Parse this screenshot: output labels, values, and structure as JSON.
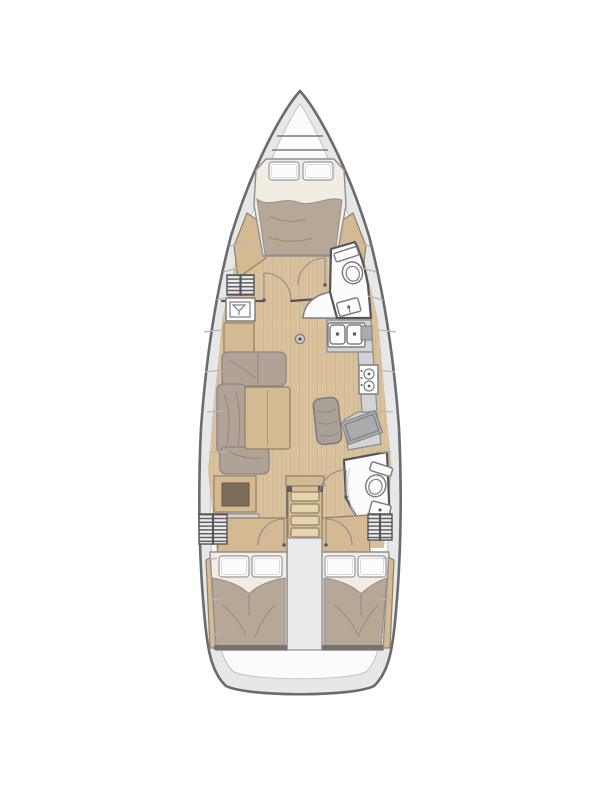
{
  "title": "sailing-yacht-interior-floor-plan",
  "colors": {
    "background": "#ffffff",
    "hull-outline": "#6a6b6e",
    "deck": "#e6e7e8",
    "liner": "#fbfbfb",
    "wall": "#54555a",
    "floor-wood": "#d9c19c",
    "floor-grain": "#c9ae85",
    "wood-trim": "#d4ba92",
    "wood-dark": "#7c6c5a",
    "cushion": "#b0a295",
    "blanket": "#b6a796",
    "sheet": "#f2ede3",
    "pillow": "#fcfcfc",
    "counter": "#d2d3d5",
    "counter-dark": "#a9abad",
    "fixture": "#fcfcfc",
    "fixture-line": "#7e7f83",
    "seat": "#a9a198",
    "engine": "#e9eaeb",
    "line-light": "#b5b6b8",
    "arc": "#8b8c8f",
    "hatch": "#5f6063",
    "footboard": "#74736f"
  },
  "features": {
    "bow-anchor-locker": "anchor locker at bow",
    "forward-cabin": "forward V-berth double cabin with two pillows",
    "forward-head": "forward bathroom with toilet and sink",
    "salon": "L-shaped settee with wooden table and mast post",
    "galley": "L-shaped galley with double sink and two-burner stove",
    "nav-station": "chart table with bench seat",
    "aft-head": "aft bathroom with toilet, sink and shower",
    "companionway": "companionway ladder with four steps",
    "engine-compartment": "engine box between aft cabins",
    "aft-cabin-port": "port aft double cabin with two pillows",
    "aft-cabin-starboard": "starboard aft double cabin with two pillows",
    "swim-platform": "transom swim platform"
  },
  "layout_summary": {
    "cabins": 3,
    "heads": 2,
    "double_berths": 3
  }
}
